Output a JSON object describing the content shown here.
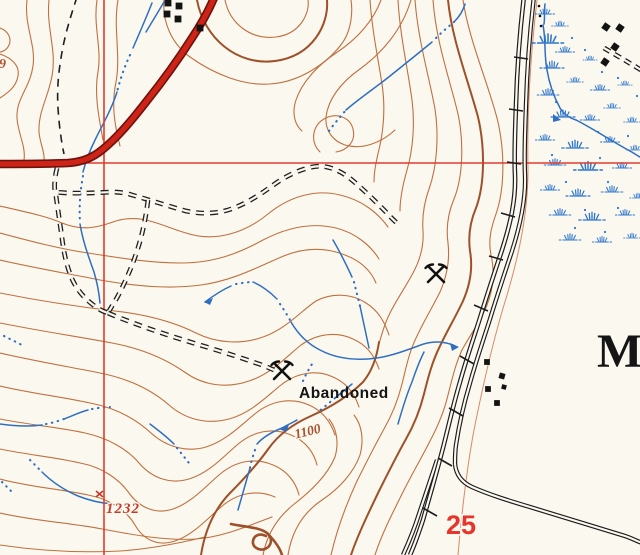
{
  "map": {
    "labels": {
      "mine_status": "Abandoned",
      "contour_elevation": "1100",
      "spot_elevation": "1232",
      "section_number": "25",
      "place_name_partial": "M",
      "edge_elevation_digit": "9"
    },
    "colors": {
      "background": "#fbf8f0",
      "contour": "#c0703d",
      "contour_index": "#9e5128",
      "grid_line": "#e33b2d",
      "highway_fill": "#ce2418",
      "highway_casing": "#6d120c",
      "water": "#2f6fc0",
      "ink_black": "#1c1c1c"
    },
    "icons": [
      {
        "name": "mine-icon",
        "glyph": "crossed-picks"
      },
      {
        "name": "marsh-icon",
        "glyph": "blue-tuft"
      },
      {
        "name": "building-icon",
        "glyph": "black-square"
      },
      {
        "name": "railroad-icon",
        "glyph": "line-with-cross-ties"
      },
      {
        "name": "spot-elevation-x-icon",
        "glyph": "small-red-x"
      }
    ]
  }
}
